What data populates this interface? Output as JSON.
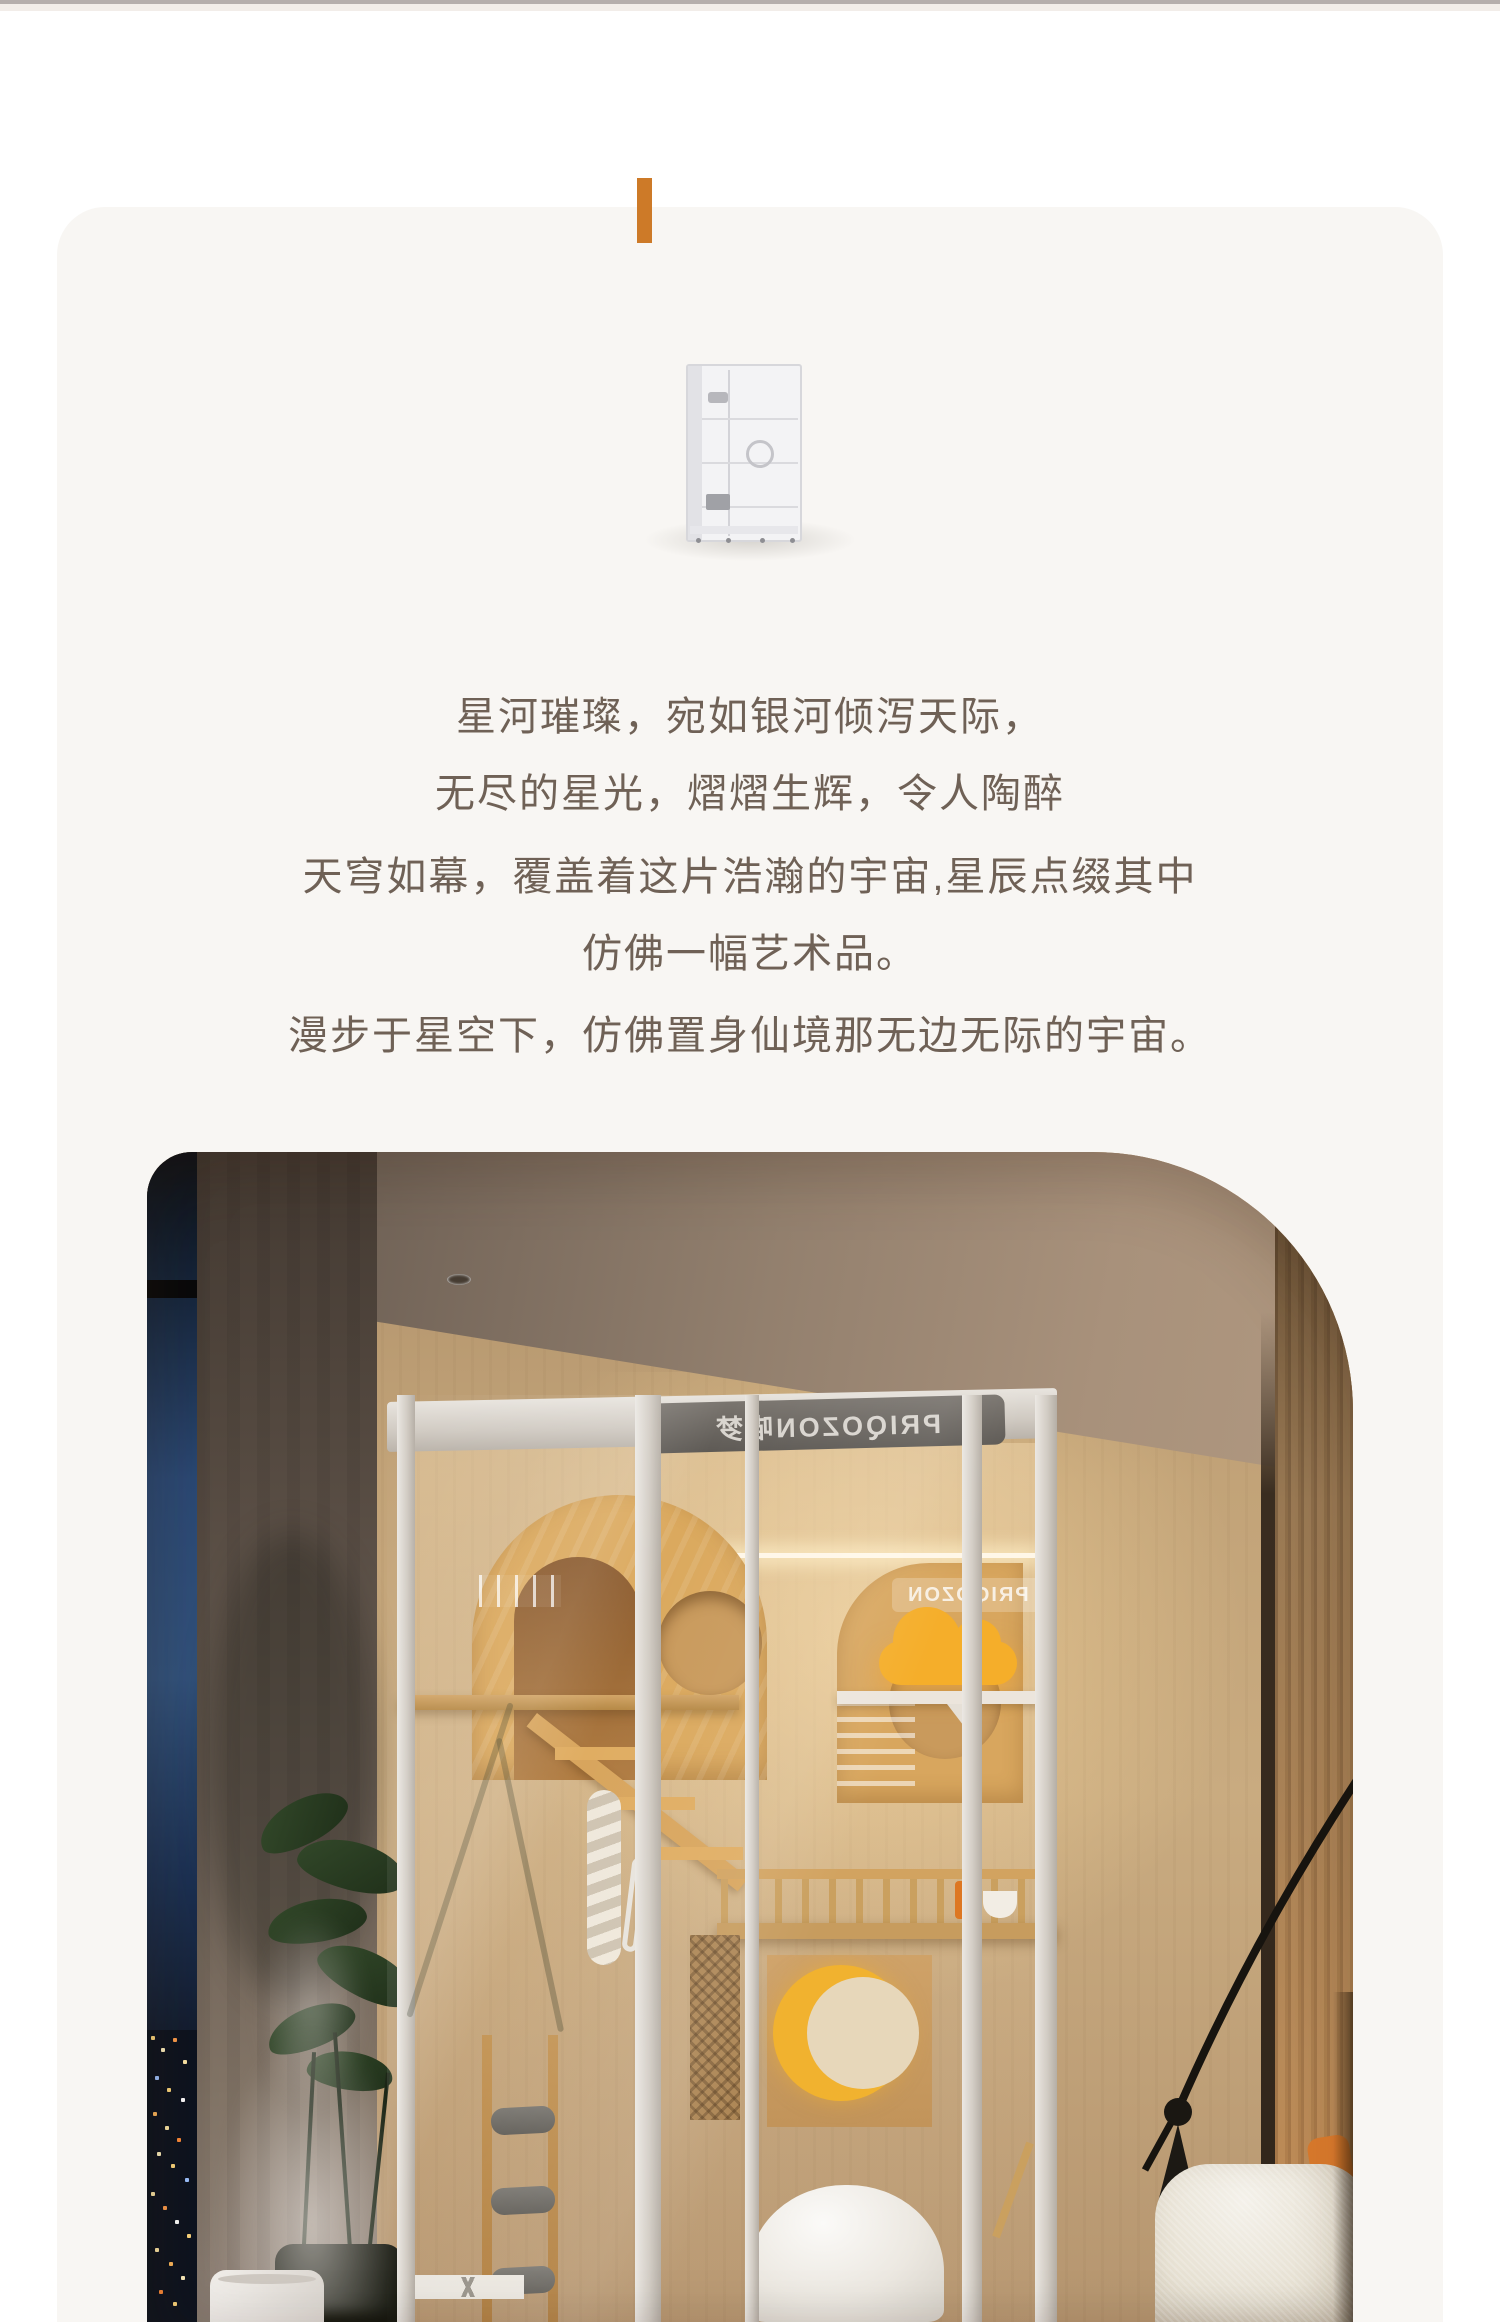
{
  "page": {
    "background": "#ffffff",
    "card_background": "#f8f6f3",
    "accent_color": "#cd7a28",
    "top_divider_color": "#b5aeac",
    "text_color": "#6f6156"
  },
  "intro": {
    "lines": [
      "星河璀璨，宛如银河倾泻天际，",
      "无尽的星光，熠熠生辉，令人陶醉",
      "天穹如幕，覆盖着这片浩瀚的宇宙,星辰点缀其中",
      "仿佛一幅艺术品。",
      "漫步于星空下，仿佛置身仙境那无边无际的宇宙。"
    ]
  },
  "photo": {
    "cage_logo": "PRIQOZON喵梦",
    "cage_inner_sign": "PRIQOZON",
    "alt": "夜景窗边客厅中的白色铝框玻璃猫别墅，原木猫爬架、黄色云朵与月亮装饰、落地灯与白色坐凳",
    "accent_cloud_color": "#f5ae2a",
    "accent_moon_color": "#f1b22f",
    "wood_color": "#d9a75f",
    "cushion_color": "#d8792c"
  }
}
